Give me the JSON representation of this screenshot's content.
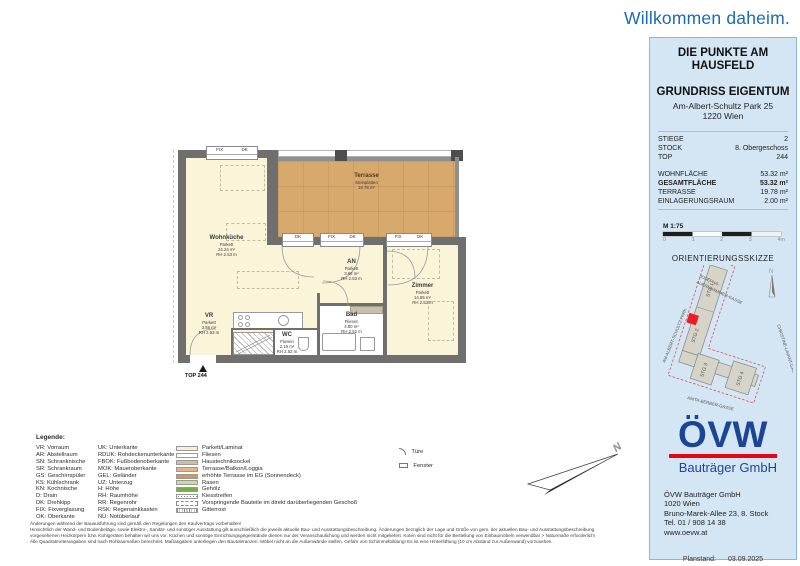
{
  "page": {
    "welcome": "Willkommen daheim."
  },
  "project": {
    "title_line1": "DIE PUNKTE AM",
    "title_line2": "HAUSFELD",
    "plan_type": "GRUNDRISS EIGENTUM",
    "address_line1": "Am-Albert-Schultz Park 25",
    "address_line2": "1220 Wien"
  },
  "unit": {
    "stiege_label": "STIEGE",
    "stiege": "2",
    "stock_label": "STOCK",
    "stock": "8. Obergeschoss",
    "top_label": "TOP",
    "top": "244",
    "wohnflaeche_label": "WOHNFLÄCHE",
    "wohnflaeche": "53.32 m²",
    "gesamtflaeche_label": "GESAMTFLÄCHE",
    "gesamtflaeche": "53.32 m²",
    "terrasse_label": "TERRASSE",
    "terrasse": "19.78 m²",
    "einlagerungsraum_label": "EINLAGERUNGSRAUM",
    "einlagerungsraum": "2.00 m²"
  },
  "scalebar": {
    "label": "M 1:75",
    "ticks": [
      "0",
      "1",
      "2",
      "3",
      "4m"
    ]
  },
  "orientation": {
    "title": "ORIENTIERUNGSSKIZZE",
    "street_top1": "JOSEPHA-",
    "street_top2": "AUERNHAMMER-GASSE",
    "street_left": "AM-ALBERT-SCHULTZ-PARK",
    "street_bottom": "ANITA-BERBER-GASSE",
    "street_right": "CHRISTINE-LAVANT-GASSE",
    "stg1": "STG 1",
    "stg2": "STG 2",
    "stg3": "STG 3",
    "stg4": "STG 4",
    "north": "N",
    "marker_color": "#ee1c25"
  },
  "floorplan": {
    "unit_marker": "TOP 244",
    "rooms": {
      "terrasse": {
        "name": "Terrasse",
        "l1": "Steinplatten",
        "l2": "19.78 m²"
      },
      "wohnkueche": {
        "name": "Wohnküche",
        "l1": "Parkett",
        "l2": "24.24 m²",
        "l3": "RH 2.53 m"
      },
      "vr": {
        "name": "VR",
        "l1": "Parkett",
        "l2": "3.56 m²",
        "l3": "RH 2.53 m"
      },
      "an": {
        "name": "AN",
        "l1": "Parkett",
        "l2": "3.68 m²",
        "l3": "RH 2.53 m"
      },
      "wc": {
        "name": "WC",
        "l1": "Fliesen",
        "l2": "2.19 m²",
        "l3": "RH 2.52 m"
      },
      "bad": {
        "name": "Bad",
        "l1": "Fliesen",
        "l2": "4.80 m²",
        "l3": "RH 2.52 m"
      },
      "zimmer": {
        "name": "Zimmer",
        "l1": "Parkett",
        "l2": "14.85 m²",
        "l3": "RH 2.53 m"
      }
    },
    "windows": {
      "w1a": "FIX",
      "w1b": "DK",
      "w2": "DK",
      "w3a": "FIX",
      "w3b": "DK",
      "w4a": "FIX",
      "w4b": "DK"
    }
  },
  "legend": {
    "title": "Legende:",
    "col1": [
      "VR: Vorraum",
      "AR: Abstellraum",
      "SN: Schranknische",
      "SR: Schrankraum",
      "GS: Geschirrspüler",
      "KS: Kühlschrank",
      "KN: Kochnische",
      "D: Drain",
      "DK: Drehkipp",
      "FIX: Fixverglasung",
      "OK: Oberkante"
    ],
    "col2": [
      "UK: Unterkante",
      "RDUK: Rohdeckenunterkante",
      "FBOK: Fußbodenoberkante",
      "MOK: Maueroberkante",
      "GEL: Geländer",
      "UZ: Unterzug",
      "H: Höhe",
      "RH: Raumhöhe",
      "RR: Regenrohr",
      "RSK: Regensinkkasten",
      "NÜ: Notüberlauf"
    ],
    "swatches": [
      {
        "label": "Parkett/Laminat",
        "color": "#f6f1cf",
        "style": "solid"
      },
      {
        "label": "Fliesen",
        "color": "#ffffff",
        "style": "solid"
      },
      {
        "label": "Haustechniksockel",
        "color": "#c9c0ab",
        "style": "solid"
      },
      {
        "label": "Terrasse/Balkon/Loggia",
        "color": "#e2b586",
        "style": "solid"
      },
      {
        "label": "erhöhte Terrasse im EG (Sonnendeck)",
        "color": "#d09a58",
        "style": "solid"
      },
      {
        "label": "Rasen",
        "color": "#cdda9f",
        "style": "solid"
      },
      {
        "label": "Gehölz",
        "color": "#79ae45",
        "style": "solid"
      },
      {
        "label": "Kiesstreifen",
        "color": "#ffffff",
        "style": "dots"
      },
      {
        "label": "Vorspringende Bauteile im direkt darüberliegenden Geschoß",
        "color": "#ffffff",
        "style": "dashed"
      },
      {
        "label": "Gitterrost",
        "color": "#ffffff",
        "style": "hatch"
      }
    ],
    "symbol_door": "Türe",
    "symbol_window": "Fenster"
  },
  "company": {
    "logo_text": "ÖVW",
    "logo_sub": "Bauträger GmbH",
    "address": [
      "ÖVW Bauträger GmbH",
      "1020 Wien",
      "Bruno-Marek-Allee 23, 8. Stock",
      "Tel. 01 / 908 14 38",
      "www.oevw.at"
    ],
    "planstand_label": "Planstand:",
    "planstand_value": "03.09.2025",
    "brand_blue": "#1c4596",
    "brand_red": "#e30613"
  },
  "disclaimer": {
    "lines": [
      "Änderungen während der Bauausführung sind gemäß den Regelungen des Kaufvertrags vorbehalten!",
      "Hinsichtlich der Wand- und Bodenbeläge, sowie Elektro-, Sanitär- und sonstiger Ausstattung gilt ausschließlich die jeweils aktuelle Bau- und Ausstattungsbeschreibung. Änderungen bezüglich der Lage und Größe von gem. der aktuellen Bau- und Ausstattungsbeschreibung",
      "vorgesehenen Heizkörpern bzw. Kühlgeräten behalten wir uns vor. Küchen und sonstige Einrichtungsgegenstände dienen nur der Veranschaulichung und werden nicht mitgeliefert. Koten sind nicht für die Bestellung von Einbaumöbeln verwendbar > Naturmaße erforderlich!",
      "Alle Quadratmeterangaben sind nach Rohbaumaßen berechnet. Maßangaben unterliegen den Bautoleranzen. Möbel nicht an die Außenwände stellen. Gefahr von Schimmelbildung! Es ist eine Hinterlüftung (10 cm Abstand zur Außenwand) vorzusehen."
    ]
  }
}
